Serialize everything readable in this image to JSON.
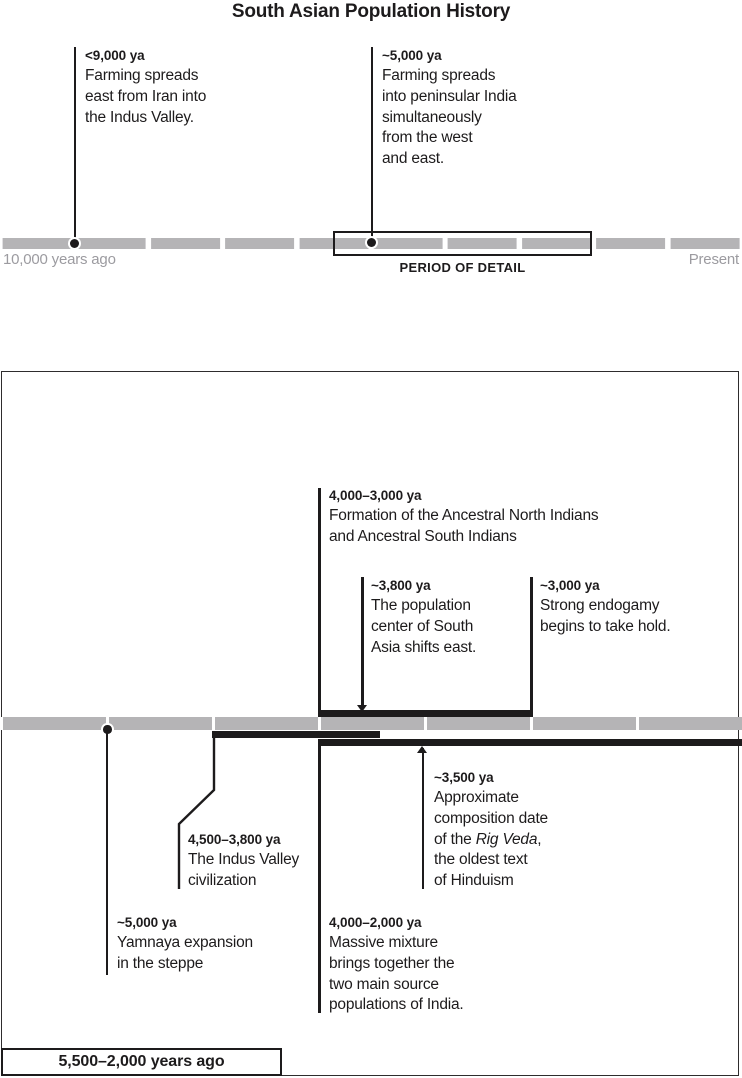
{
  "title": "South Asian Population History",
  "colors": {
    "ink": "#1d1b1c",
    "bar_gray": "#b5b4b6",
    "muted_gray": "#9c9ba0",
    "border_gray": "#2e2c2d"
  },
  "overview_timeline": {
    "start_label": "10,000 years ago",
    "end_label": "Present",
    "detail_marker_label": "PERIOD OF DETAIL",
    "events": {
      "farming_iran": {
        "date": "<9,000 ya",
        "lines": [
          "Farming spreads",
          "east from Iran into",
          "the Indus Valley."
        ]
      },
      "farming_peninsular": {
        "date": "~5,000 ya",
        "lines": [
          "Farming spreads",
          "into peninsular India",
          "simultaneously",
          "from the west",
          "and east."
        ]
      }
    }
  },
  "detail_timeline": {
    "range_label": "5,500–2,000 years ago",
    "events": {
      "formation": {
        "date": "4,000–3,000 ya",
        "lines": [
          "Formation of the Ancestral North Indians",
          "and Ancestral South Indians"
        ]
      },
      "population_shift": {
        "date": "~3,800 ya",
        "lines": [
          "The population",
          "center of South",
          "Asia shifts east."
        ]
      },
      "endogamy": {
        "date": "~3,000 ya",
        "lines": [
          "Strong endogamy",
          "begins to take hold."
        ]
      },
      "indus_valley": {
        "date": "4,500–3,800 ya",
        "lines": [
          "The Indus Valley",
          "civilization"
        ]
      },
      "rig_veda": {
        "date": "~3,500 ya",
        "line1": "Approximate",
        "line2": "composition date",
        "line3_prefix": "of the ",
        "line3_italic": "Rig Veda",
        "line3_suffix": ",",
        "line4": "the oldest text",
        "line5": "of Hinduism"
      },
      "yamnaya": {
        "date": "~5,000 ya",
        "lines": [
          "Yamnaya expansion",
          "in the steppe"
        ]
      },
      "mixture": {
        "date": "4,000–2,000 ya",
        "lines": [
          "Massive mixture",
          "brings together the",
          "two main source",
          "populations of India."
        ]
      }
    }
  }
}
